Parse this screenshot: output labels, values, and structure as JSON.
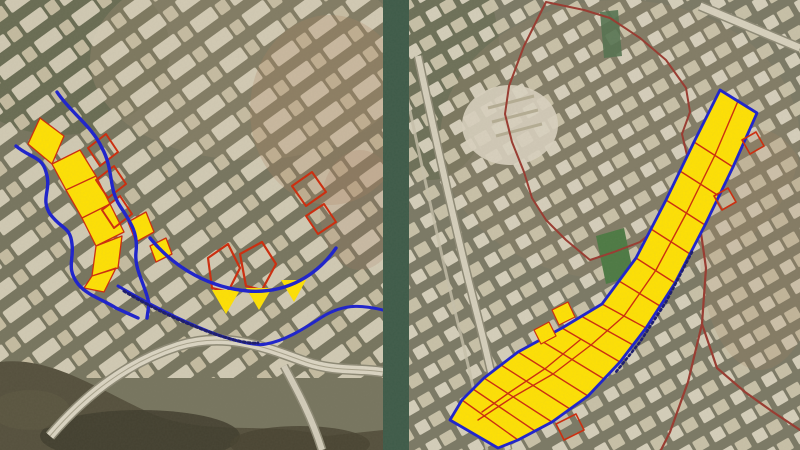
{
  "figure": {
    "type": "satellite-map-comparison",
    "panel_count": 2,
    "divider_color": "#3E5B49"
  },
  "colors": {
    "parcelYellow": "#FFE104",
    "lineBlue": "#1C21CE",
    "outlineRed": "#CE2B0C",
    "boundaryMaroon": "#993A30",
    "labelInk": "#1A1A6E",
    "fieldGreen": "#4D7A44"
  },
  "panels": [
    {
      "id": "left",
      "name": "left-satellite-map",
      "annotations": [
        {
          "name": "highlight-parcel-band",
          "d": "M40,118 L64,136 L52,164 L28,144 Z M52,164 L80,150 L96,176 L66,190 Z M66,190 L96,176 L110,204 L82,218 Z M82,218 L110,204 L124,232 L96,246 Z M96,246 L122,236 L118,268 L92,276 Z M92,276 L116,268 L104,292 L84,288 Z M128,222 L146,212 L154,232 L136,242 Z M150,246 L166,238 L172,254 L156,262 Z",
          "fill": "parcelYellow",
          "stroke": "outlineRed",
          "sw": 1.3
        },
        {
          "name": "red-parcel-outlines",
          "d": "M88,148 L106,134 L118,152 L100,166 Z M96,180 L114,166 L126,184 L108,198 Z M102,210 L120,196 L132,214 L114,228 Z M292,186 L312,172 L326,192 L306,206 Z M306,216 L324,204 L336,222 L318,234 Z",
          "fill": "none",
          "stroke": "outlineRed",
          "sw": 2
        },
        {
          "name": "red-parcel-outlines-large",
          "d": "M208,258 L228,244 L240,268 L228,292 L212,288 Z M240,254 L262,242 L276,264 L262,290 L246,286 Z",
          "fill": "none",
          "stroke": "outlineRed",
          "sw": 2.2
        },
        {
          "name": "highlight-triangles",
          "d": "M212,290 L240,290 L226,314 Z M246,288 L272,288 L259,310 Z M281,280 L306,280 L294,302 Z",
          "fill": "parcelYellow",
          "stroke": "none"
        },
        {
          "name": "alignment-line-east",
          "d": "M57,92 C70,112 92,126 102,148 C114,170 108,188 120,206 C132,224 138,234 136,252 C134,270 146,286 149,304 L147,318",
          "fill": "none",
          "stroke": "lineBlue",
          "sw": 3.4
        },
        {
          "name": "alignment-line-west",
          "d": "M16,146 C30,158 42,156 46,172 C52,190 40,198 50,214 C62,230 70,226 72,244 C74,260 66,268 78,284 C88,296 104,300 116,308 L138,318",
          "fill": "none",
          "stroke": "lineBlue",
          "sw": 3.4
        },
        {
          "name": "alignment-arc-mid",
          "d": "M150,238 C176,270 212,288 248,291 C288,294 318,274 336,248",
          "fill": "none",
          "stroke": "lineBlue",
          "sw": 3.4
        },
        {
          "name": "alignment-line-south",
          "d": "M118,286 C152,306 188,324 218,335 C242,343 258,346 266,344 C284,341 302,330 322,317 C346,302 366,306 383,310",
          "fill": "none",
          "stroke": "lineBlue",
          "sw": 3
        },
        {
          "name": "route-label-marks",
          "d": "M124,291 C152,308 182,322 212,333 C232,340 248,344 258,343",
          "fill": "none",
          "stroke": "labelInk",
          "sw": 3,
          "dash": "2 3"
        }
      ]
    },
    {
      "id": "right",
      "name": "right-satellite-map",
      "annotations": [
        {
          "name": "study-boundary-upper",
          "d": "M546,2 L584,10 L610,18 L640,38 L666,60 L686,88 L690,112 L682,134 L690,168 L686,196 L664,222 L640,242 L614,252 L590,260 L566,240 L546,220 L532,198 L524,172 L512,142 L505,114 L509,86 L524,46 Z",
          "fill": "none",
          "stroke": "boundaryMaroon",
          "sw": 2
        },
        {
          "name": "study-boundary-lower",
          "d": "M700,226 L706,268 L702,324 L717,368 L745,392 L773,412 L800,430 M702,324 L688,382 L670,432 L661,450",
          "fill": "none",
          "stroke": "boundaryMaroon",
          "sw": 2.2
        },
        {
          "name": "corridor-fill",
          "d": "M720,90 L757,113 L733,167 L705,225 L675,283 L646,328 L620,362 L588,396 L552,422 L518,440 L498,448 L450,420 L462,400 L484,378 L518,352 L562,328 L602,304 L636,258 L666,200 L694,142 Z",
          "fill": "parcelYellow",
          "stroke": "none"
        },
        {
          "name": "corridor-parcel-grid",
          "d": "M694,142 L733,167 M680,171 L719,196 M666,200 L705,225 M651,229 L690,254 M636,258 L675,283 M619,281 L660,306 M602,304 L646,328 M581,316 L633,345 M562,328 L620,362 M540,340 L604,379 M518,352 L588,396 M501,365 L570,409 M484,378 L552,422 M473,389 L535,431 M462,400 L518,440 M738,101 L715,155 L687,212 L656,270 L624,316 L591,345 L553,374 L513,397 L478,420 M580,340 L546,368 L510,392 L482,412",
          "fill": "none",
          "stroke": "outlineRed",
          "sw": 1.4
        },
        {
          "name": "corridor-edge-lines",
          "d": "M720,90 L757,113 L733,167 L705,225 L675,283 L646,328 L620,362 L588,396 L552,422 L518,440 L498,448 L450,420 L462,400 L484,378 L518,352 L562,328 L602,304 L636,258 L666,200 L694,142 Z",
          "fill": "none",
          "stroke": "lineBlue",
          "sw": 2.8
        },
        {
          "name": "route-label-marks",
          "d": "M692,252 L666,302 L640,342 L616,372",
          "fill": "none",
          "stroke": "labelInk",
          "sw": 2.6,
          "dash": "2 3"
        },
        {
          "name": "detached-parcels",
          "d": "M552,310 L568,302 L575,317 L559,325 Z M534,330 L549,322 L556,336 L541,344 Z",
          "fill": "parcelYellow",
          "stroke": "outlineRed",
          "sw": 1.2
        },
        {
          "name": "red-parcel-outlines",
          "d": "M742,140 L756,132 L764,146 L750,154 Z M714,196 L728,188 L736,202 L722,210 Z M556,424 L576,414 L584,430 L564,440 Z",
          "fill": "none",
          "stroke": "outlineRed",
          "sw": 1.6
        }
      ]
    }
  ]
}
